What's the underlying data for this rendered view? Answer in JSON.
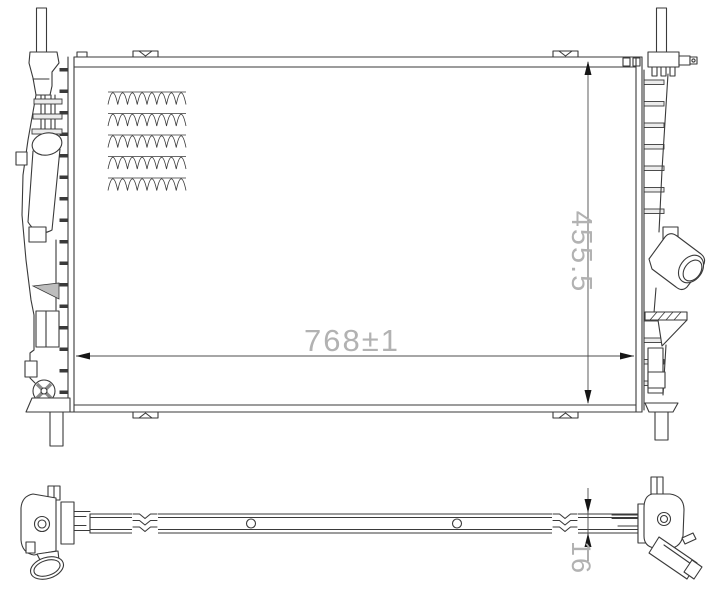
{
  "drawing": {
    "dimensions": {
      "width": "768±1",
      "height": "455.5",
      "thickness": "16"
    },
    "colors": {
      "line": "#3a3a3a",
      "dimension_text": "#b2b2b2",
      "background": "#ffffff"
    }
  }
}
